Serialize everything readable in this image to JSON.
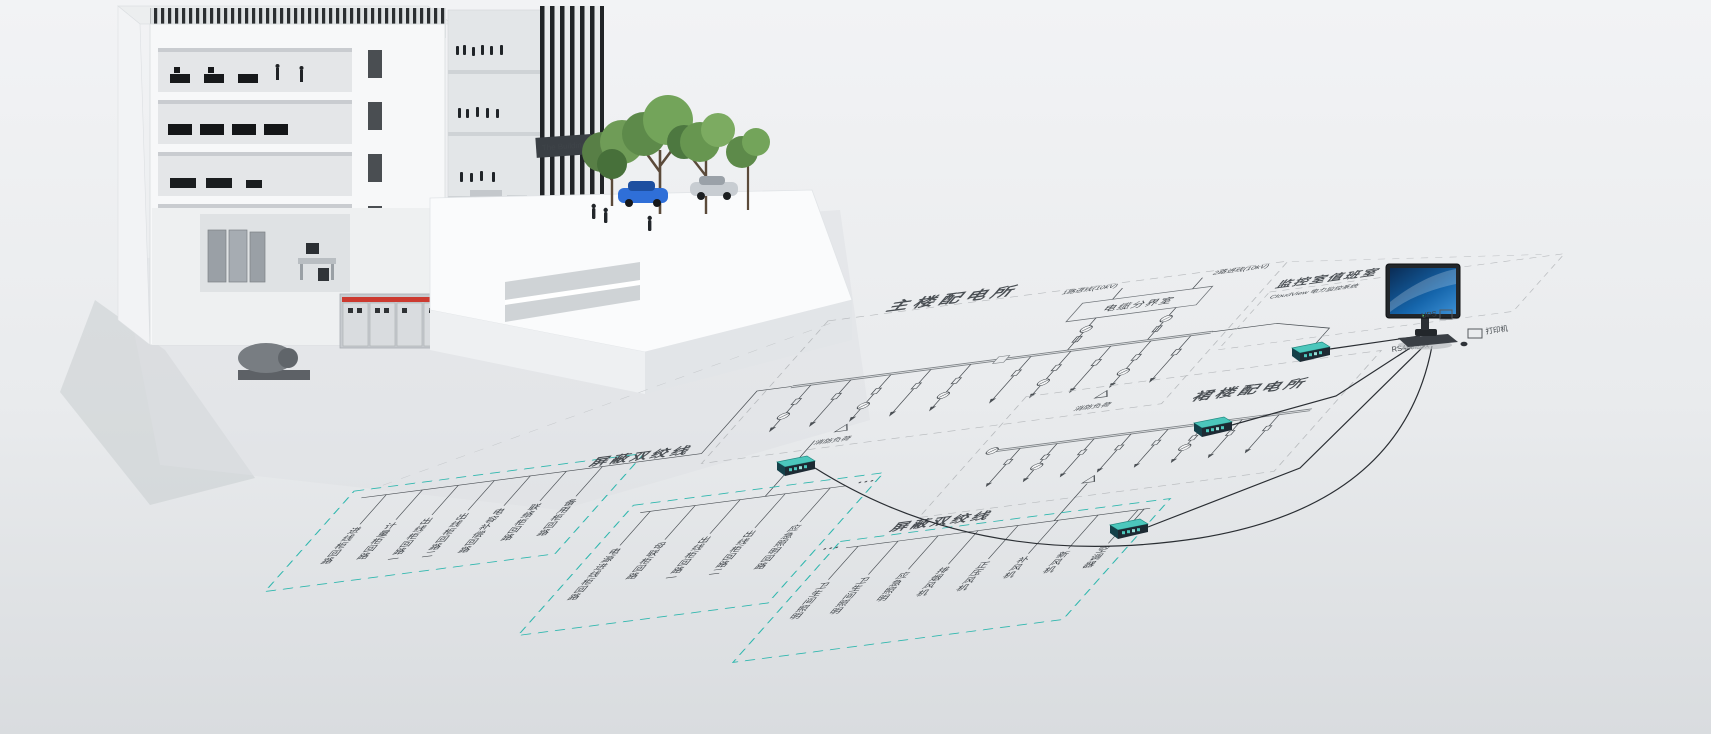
{
  "building": {
    "sign_label": "The Building"
  },
  "diagram": {
    "colors": {
      "teal": "#2fb7ae",
      "ink": "#4a4f54",
      "dash_gray": "#b7babd"
    },
    "main_substation_label": "主楼配电所",
    "podium_substation_label": "裙楼配电所",
    "cable_room_label": "电缆分界室",
    "incoming_line_1": "1路进线(10kV)",
    "incoming_line_2": "2路进线(10kV)",
    "shielded_pair_label_1": "屏蔽双绞线",
    "shielded_pair_label_2": "屏蔽双绞线",
    "fire_load_label_1": "消防负荷",
    "fire_load_label_2": "消防负荷",
    "monitor_room": {
      "label": "监控室值班室",
      "subtitle": "CloudView 电力监控系统",
      "ups_label": "UPS",
      "printer_label": "打印机",
      "bus_label": "RS485总线"
    },
    "circuits": {
      "g1": [
        "进线柜回路",
        "计量柜回路",
        "出线柜回路一",
        "出线柜回路二",
        "电容补偿回路",
        "联络柜回路",
        "备用柜回路"
      ],
      "g2": [
        "电源进线柜回路",
        "母联柜回路",
        "出线柜回路一",
        "出线柜回路二",
        "应急照明回路"
      ],
      "g3": [
        "卫生间照明",
        "卫生间照明",
        "应急照明",
        "排烟风机",
        "正压风机",
        "补风机",
        "新风机",
        "空调器"
      ]
    }
  }
}
